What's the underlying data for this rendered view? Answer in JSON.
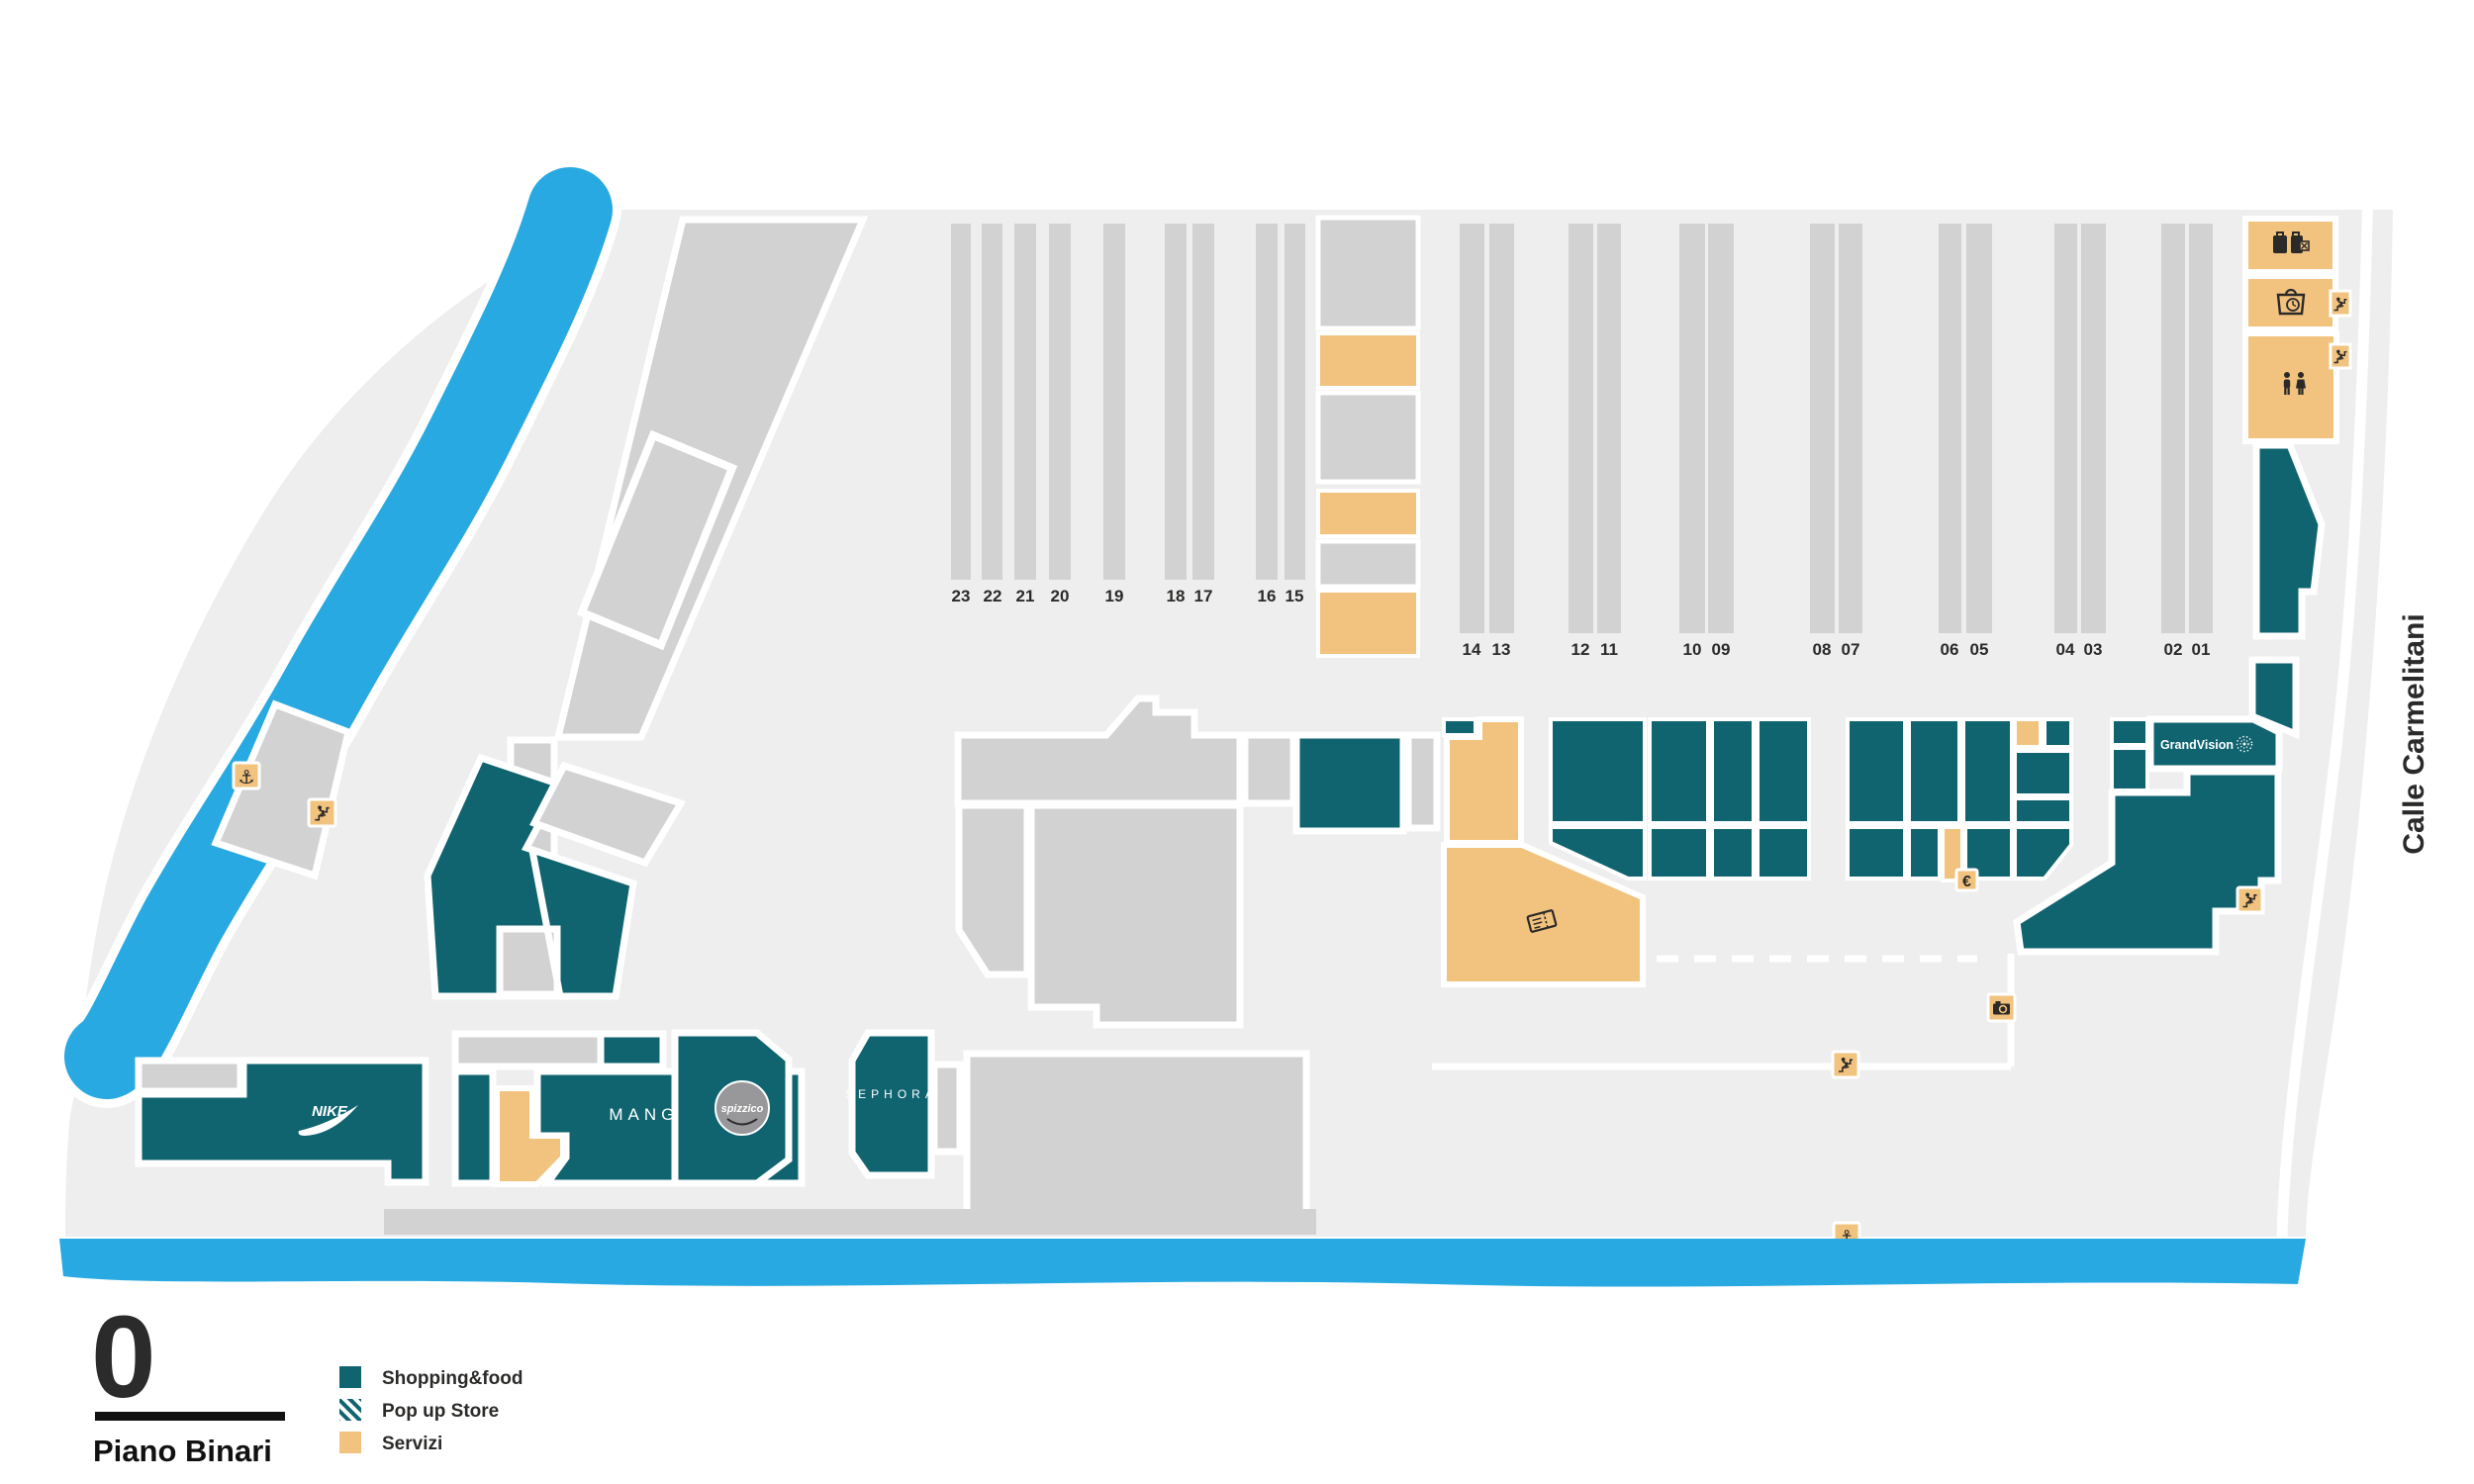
{
  "map": {
    "floor_number": "0",
    "floor_name": "Piano Binari",
    "street_label": "Calle Carmelitani",
    "legend": [
      {
        "label": "Shopping&food",
        "style": "solid-teal"
      },
      {
        "label": "Pop up Store",
        "style": "striped-teal"
      },
      {
        "label": "Servizi",
        "style": "solid-tan"
      }
    ],
    "tracks_west": [
      "23",
      "22",
      "21",
      "20",
      "19",
      "18",
      "17",
      "16",
      "15"
    ],
    "tracks_east": [
      "14",
      "13",
      "12",
      "11",
      "10",
      "09",
      "08",
      "07",
      "06",
      "05",
      "04",
      "03",
      "02",
      "01"
    ],
    "stores": {
      "nike": "NIKE",
      "mango": "MANGO",
      "spizzico": "spizzico",
      "sephora": "SEPHORA",
      "grandvision": "GrandVision"
    },
    "symbols": {
      "anchor": "⚓",
      "euro": "€"
    },
    "colors": {
      "shopping": "#106470",
      "services": "#F2C37E",
      "water": "#29A9E1",
      "platform": "#D2D2D3",
      "floor": "#EEEEEF",
      "text": "#2B2A29"
    }
  }
}
